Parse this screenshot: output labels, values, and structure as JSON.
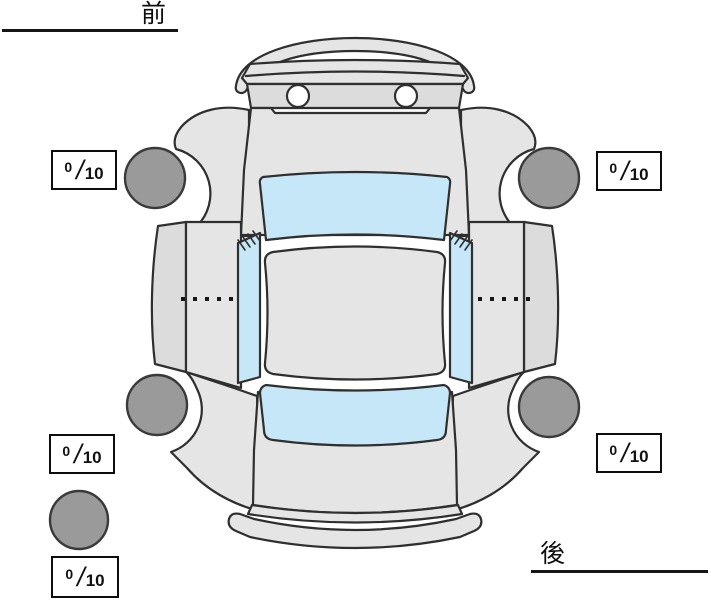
{
  "diagram": {
    "front_label": "前",
    "rear_label": "後",
    "score_slash": "/",
    "score_max": "10",
    "scores": {
      "front_left": {
        "value": "0"
      },
      "front_right": {
        "value": "0"
      },
      "rear_left": {
        "value": "0"
      },
      "rear_right": {
        "value": "0"
      },
      "spare": {
        "value": "0"
      }
    },
    "colors": {
      "body": "#e5e5e5",
      "panel": "#dcdcdc",
      "window": "#c6e7f8",
      "tire": "#9a9a9a",
      "outline": "#2f2f2f",
      "line": "#161616"
    }
  }
}
